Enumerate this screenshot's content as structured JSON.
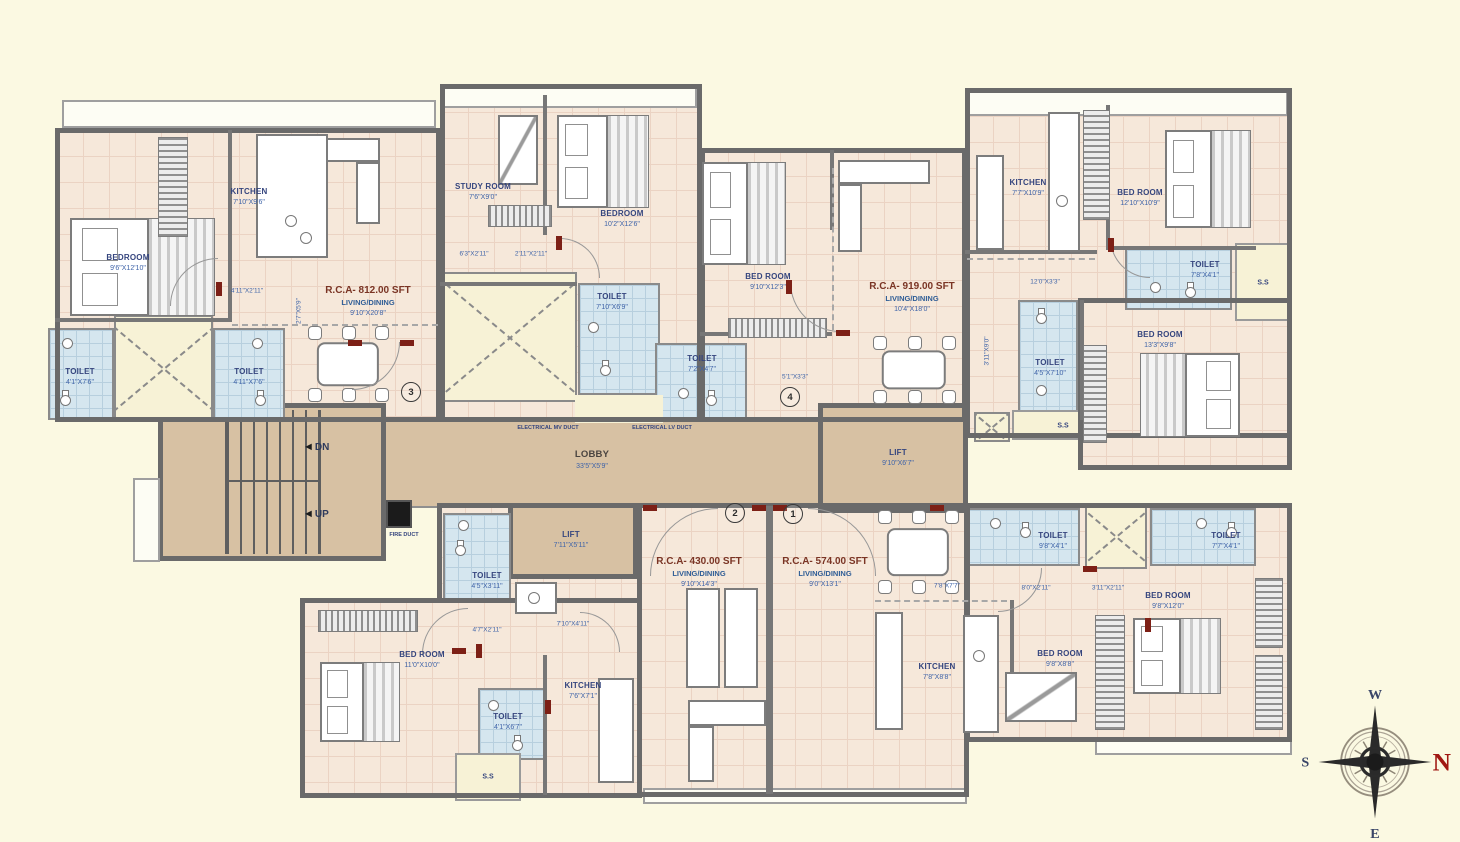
{
  "plan": {
    "rooms": {
      "bedroom_tl": {
        "name": "BEDROOM",
        "dim": "9'6\"X12'10\""
      },
      "kitchen_tl": {
        "name": "KITCHEN",
        "dim": "7'10\"X9'6\""
      },
      "toilet_tl_a": {
        "name": "TOILET",
        "dim": "4'1\"X7'6\""
      },
      "toilet_tl_b": {
        "name": "TOILET",
        "dim": "4'11\"X7'6\""
      },
      "study": {
        "name": "STUDY ROOM",
        "dim": "7'6\"X9'0\""
      },
      "bedroom_tm": {
        "name": "BEDROOM",
        "dim": "10'2\"X12'6\""
      },
      "toilet_tm_a": {
        "name": "TOILET",
        "dim": "7'10\"X6'9\""
      },
      "toilet_tm_b": {
        "name": "TOILET",
        "dim": "7'2\"X4'7\""
      },
      "bedroom_u4": {
        "name": "BED ROOM",
        "dim": "9'10\"X12'3\""
      },
      "kitchen_tr": {
        "name": "KITCHEN",
        "dim": "7'7\"X10'9\""
      },
      "bedroom_tr_a": {
        "name": "BED ROOM",
        "dim": "12'10\"X10'9\""
      },
      "toilet_tr_a": {
        "name": "TOILET",
        "dim": "7'8\"X4'1\""
      },
      "bedroom_tr_b": {
        "name": "BED ROOM",
        "dim": "13'3\"X9'8\""
      },
      "toilet_tr_b": {
        "name": "TOILET",
        "dim": "4'5\"X7'10\""
      },
      "bedroom_bl": {
        "name": "BED ROOM",
        "dim": "11'0\"X10'0\""
      },
      "toilet_bl_a": {
        "name": "TOILET",
        "dim": "4'5\"X3'11\""
      },
      "toilet_bl_b": {
        "name": "TOILET",
        "dim": "4'1\"X6'7\""
      },
      "kitchen_bl": {
        "name": "KITCHEN",
        "dim": "7'6\"X7'1\""
      },
      "kitchen_br": {
        "name": "KITCHEN",
        "dim": "7'8\"X8'8\""
      },
      "bedroom_br_a": {
        "name": "BED ROOM",
        "dim": "9'8\"X8'8\""
      },
      "bedroom_br_b": {
        "name": "BED ROOM",
        "dim": "9'8\"X12'0\""
      },
      "toilet_br_a": {
        "name": "TOILET",
        "dim": "9'8\"X4'1\""
      },
      "toilet_br_b": {
        "name": "TOILET",
        "dim": "7'7\"X4'1\""
      }
    },
    "rca": {
      "u3": {
        "title": "R.C.A- 812.00 SFT",
        "sub": "LIVING/DINING",
        "dim": "9'10\"X20'8\""
      },
      "u4": {
        "title": "R.C.A- 919.00 SFT",
        "sub": "LIVING/DINING",
        "dim": "10'4\"X18'0\""
      },
      "u2": {
        "title": "R.C.A- 430.00 SFT",
        "sub": "LIVING/DINING",
        "dim": "9'10\"X14'3\""
      },
      "u1": {
        "title": "R.C.A- 574.00 SFT",
        "sub": "LIVING/DINING",
        "dim": "9'0\"X13'1\""
      }
    },
    "core": {
      "lobby": {
        "name": "LOBBY",
        "dim": "33'5\"X5'9\""
      },
      "lift_main": {
        "name": "LIFT",
        "dim": "9'10\"X6'7\""
      },
      "lift_small": {
        "name": "LIFT",
        "dim": "7'11\"X5'11\""
      },
      "dn": "DN",
      "up": "UP",
      "fire_duct": "FIRE DUCT",
      "elec_mv": "ELECTRICAL MV DUCT",
      "elec_lv": "ELECTRICAL LV DUCT",
      "ss": "S.S"
    },
    "unit_numbers": {
      "u1": "1",
      "u2": "2",
      "u3": "3",
      "u4": "4"
    },
    "dims": {
      "d2": "4'11\"X2'11\"",
      "d3": "2'7\"X5'9\"",
      "d4": "6'3\"X2'11\"",
      "d5": "2'11\"X2'11\"",
      "d6": "12'0\"X3'3\"",
      "d7": "3'11\"X9'0\"",
      "d8": "5'1\"X3'3\"",
      "d9": "4'7\"X2'11\"",
      "d10": "7'10\"X4'11\"",
      "d11": "7'8\"X7'7\"",
      "d12": "8'0\"X2'11\"",
      "d13": "3'11\"X2'11\""
    },
    "compass": {
      "n": "N",
      "s": "S",
      "e": "E",
      "w": "W"
    },
    "icons": {
      "arrow_left": "◄"
    }
  }
}
